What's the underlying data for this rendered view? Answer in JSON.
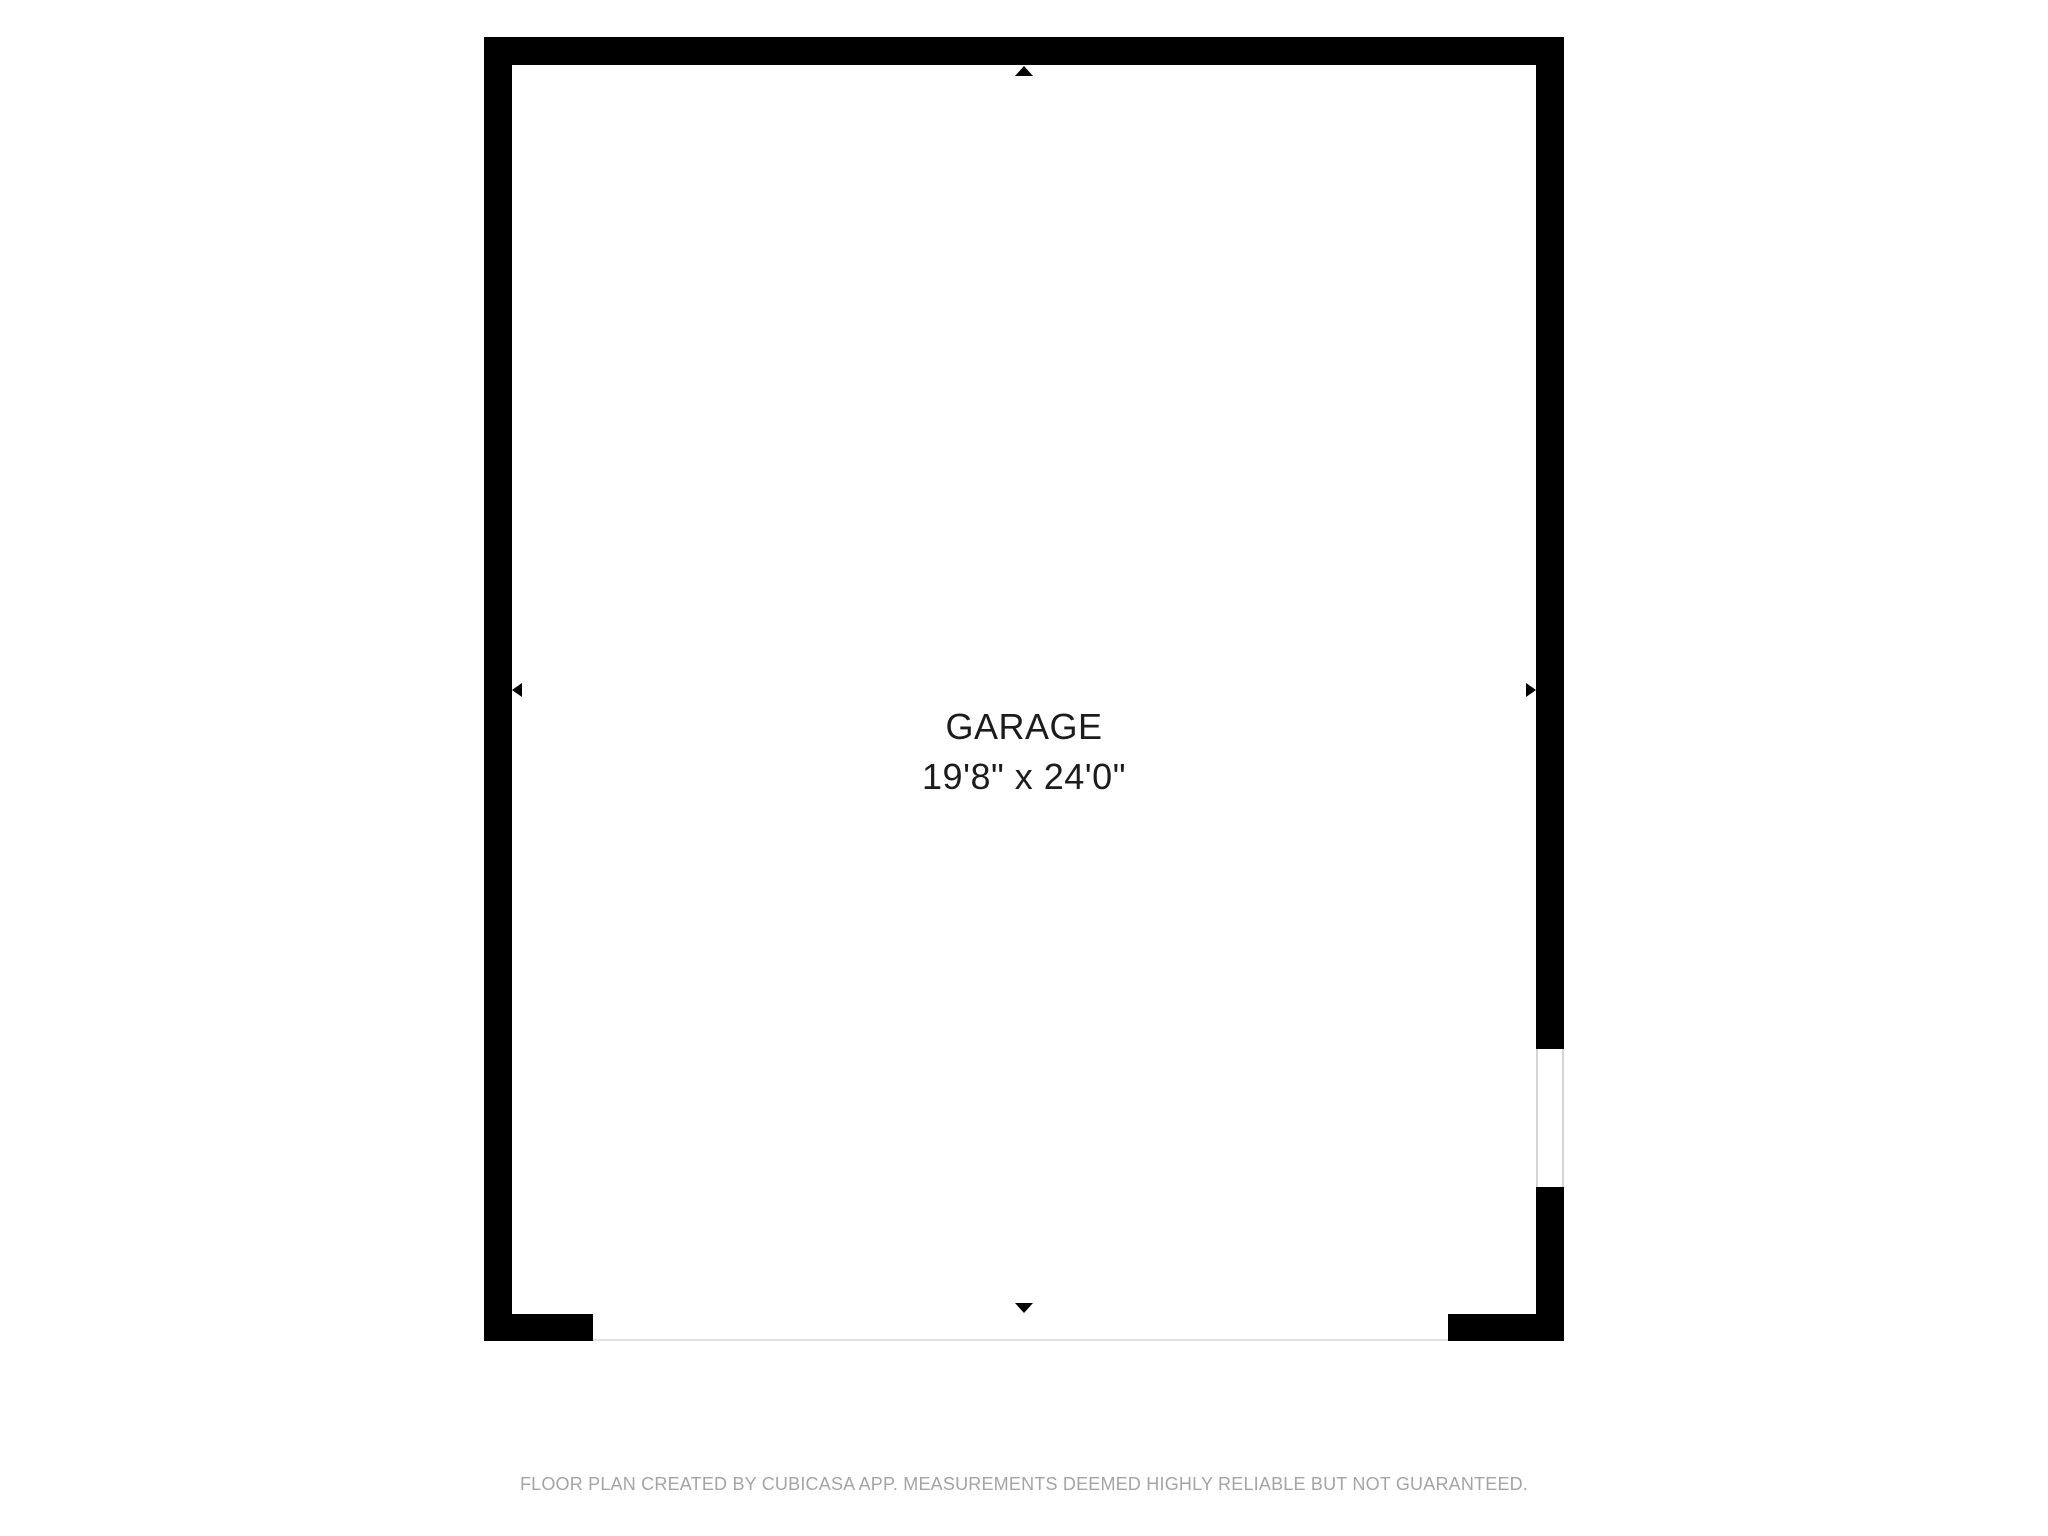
{
  "floorplan": {
    "room": {
      "name": "GARAGE",
      "dimensions": "19'8\" x 24'0\""
    },
    "features": {
      "window_right_wall": "window opening in right wall",
      "garage_door_opening": "wide opening along bottom wall"
    },
    "markers": [
      "wall-arrow-up-icon",
      "wall-arrow-down-icon",
      "wall-arrow-left-icon",
      "wall-arrow-right-icon"
    ],
    "colors": {
      "wall": "#000000",
      "room_fill": "#ffffff",
      "label_text": "#1c1c1c",
      "opening_line": "#e0e0e0",
      "window_jamb": "#d4d4d4",
      "disclaimer_text": "#a4a4a4"
    }
  },
  "footer": {
    "disclaimer": "FLOOR PLAN CREATED BY CUBICASA APP. MEASUREMENTS DEEMED HIGHLY RELIABLE BUT NOT GUARANTEED."
  }
}
